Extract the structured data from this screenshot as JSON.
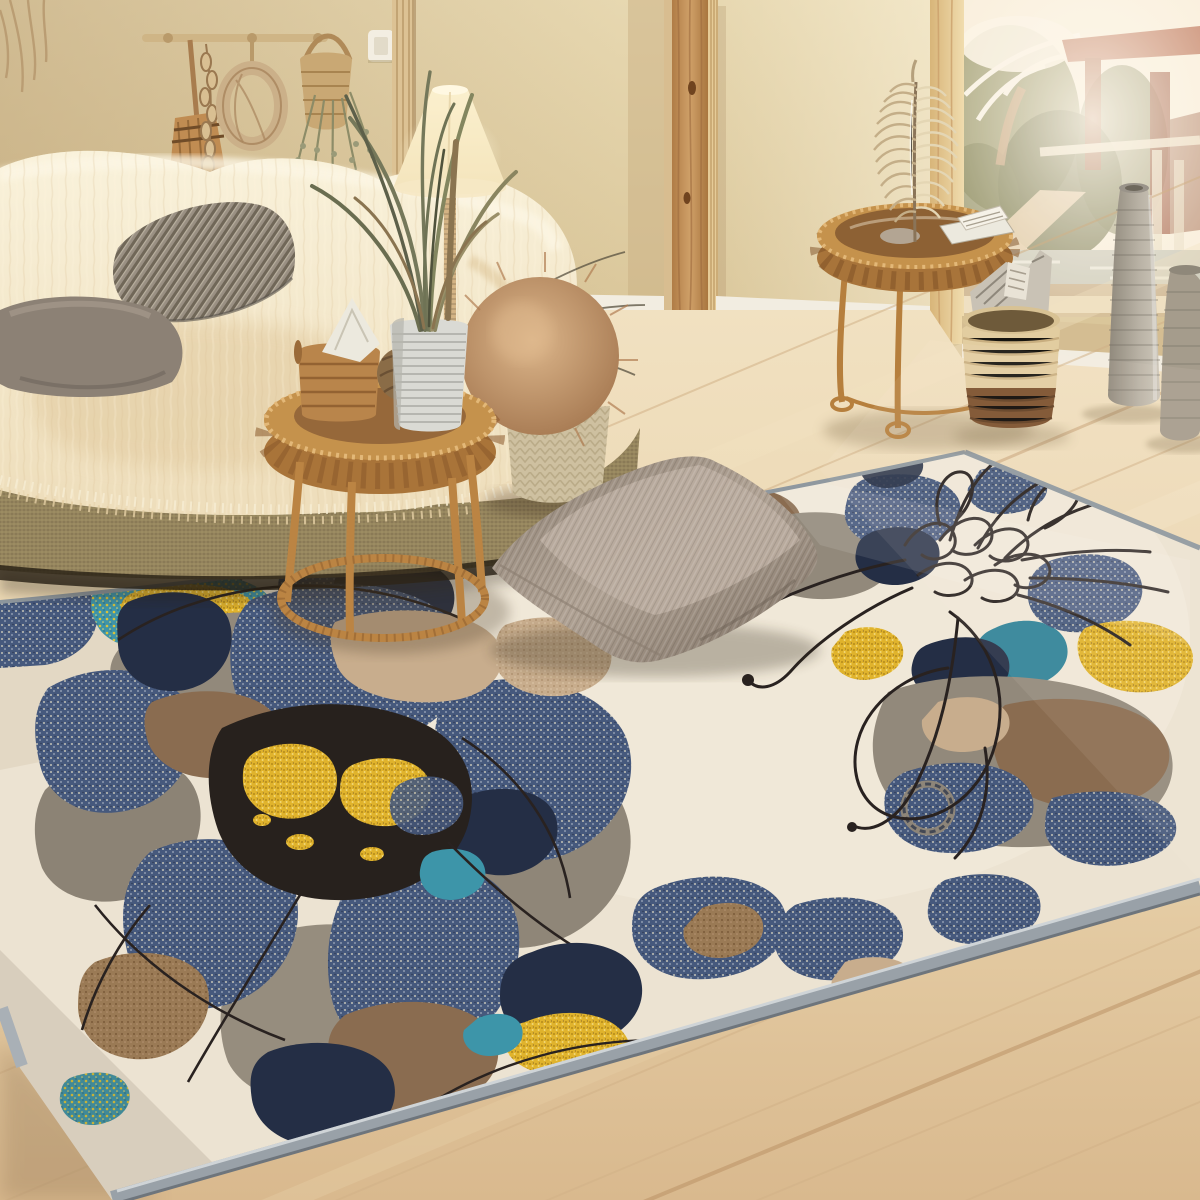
{
  "scene": {
    "type": "interior photograph",
    "room": "living room with large area rug",
    "style": "warm boho / scandinavian staging photo",
    "lighting": "bright daylight flooding from a garden window on the right, warm lamp glow on the left",
    "description": "Beige living room: sofa draped in cream sheepskin with striped and gray velvet pillows, rattan side tables (one holding a basket, yarn ball and a ribbed vase with tall grasses under a glowing fabric floor lamp, the other holding a metallic feather ornament and papers), dried botanicals hanging on the wall, a wooden post, a two-tone rope basket stuffed with magazines, two tall ribbed stone vases, light wood plank flooring, and a huge abstract floral rug in cream, denim blue, navy, taupe, brown, mustard yellow and teal with black sketch lines; a taupe corduroy floor cushion rests on the rug."
  },
  "objects": {
    "hanging_broom": "dried broom with seed-pod garland on peg rail",
    "hanging_rope": "coiled rope on peg",
    "hanging_basket": "woven pocket basket with dried lavender",
    "light_switch": "white wall switch",
    "wall_panel": "slatted wood wall strip",
    "wooden_beam": "natural pine post with knots",
    "window": "bright window to tropical garden with pond, white-blossom tree and red pavilion",
    "sofa": "woven jute-base sofa covered with cream sheepskin throw",
    "striped_pillow": "beige-gray ticking stripe pillow",
    "gray_pillow": "gray velvet pillow",
    "fur_pouf": "knitted pouf topped with brown faux-fur cushion",
    "floor_lamp": "cone fabric shade lamp with rope-wrapped pole",
    "grass_plant": "tall dried grasses in ribbed gray vase",
    "side_table_left": "round rattan tray table with storage basket, folded paper and yarn ball",
    "side_table_right": "round rattan tray table with silver feather ornament and note cards",
    "magazine_basket": "two-tone rope basket holding newspapers",
    "tall_vase": "tall ribbed stoneware floor vase",
    "small_vase": "second ribbed floor vase at right edge",
    "area_rug": "cream rug with oversized abstract flowers, speckled navy petals, dark ink centers with yellow flecks, black line-art flower, teal and mustard leaf patches, gray bound edge",
    "floor_cushion": "taupe corduroy velvet cushion lying on the rug",
    "floor": "whitewashed oak plank floor with diagonal light streaks"
  },
  "colors": {
    "wall": "#e2d2a8",
    "wall_shadow": "#c4ab7e",
    "beam": "#c69354",
    "beam_light": "#e6cb97",
    "panel_strip": "#dcc294",
    "baseboard": "#f2ede1",
    "floor": "#ecd9b6",
    "floor_grain": "#cfab7f",
    "window_light": "#f8efdc",
    "foliage": "#7d7d50",
    "roof_red": "#aa5638",
    "sheepskin": "#f6eed6",
    "fur_shade": "#e3cda4",
    "sofa_base": "#97875f",
    "striped_pillow": "#9a9083",
    "gray_pillow": "#8c8175",
    "pouf_fur": "#c49a6e",
    "pouf_base": "#cec0a0",
    "lamp_shade": "#f4e6c4",
    "lamp_glow": "#fff6d8",
    "lamp_pole": "#d3b384",
    "plant_green": "#75785a",
    "plant_vase": "#dadad4",
    "vase_rib": "#a5a59e",
    "rattan": "#c5924c",
    "rattan_dark": "#8a5a2c",
    "paper": "#ece9de",
    "yarn": "#8a6c47",
    "basket_cream": "#e2cda0",
    "basket_brown": "#7a4f2b",
    "magazines": "#c9c2b5",
    "vase_tall": "#b1aa9d",
    "vase_small": "#a59c8c",
    "feather": "#cdb995",
    "switch_plate": "#f3eee2",
    "cushion": "#a4968a",
    "cushion_light": "#bcaea1",
    "cushion_dark": "#776a5e",
    "rug_field": "#ece3d2",
    "rug_edge": "#99a1a8",
    "rug_navy": "#46597d",
    "rug_navy_dark": "#242e45",
    "rug_taupe": "#92897b",
    "rug_brown": "#8a6c50",
    "rug_tan": "#c8ad8d",
    "rug_yellow": "#e2b430",
    "rug_teal": "#3d95a9",
    "rug_line": "#292220"
  }
}
